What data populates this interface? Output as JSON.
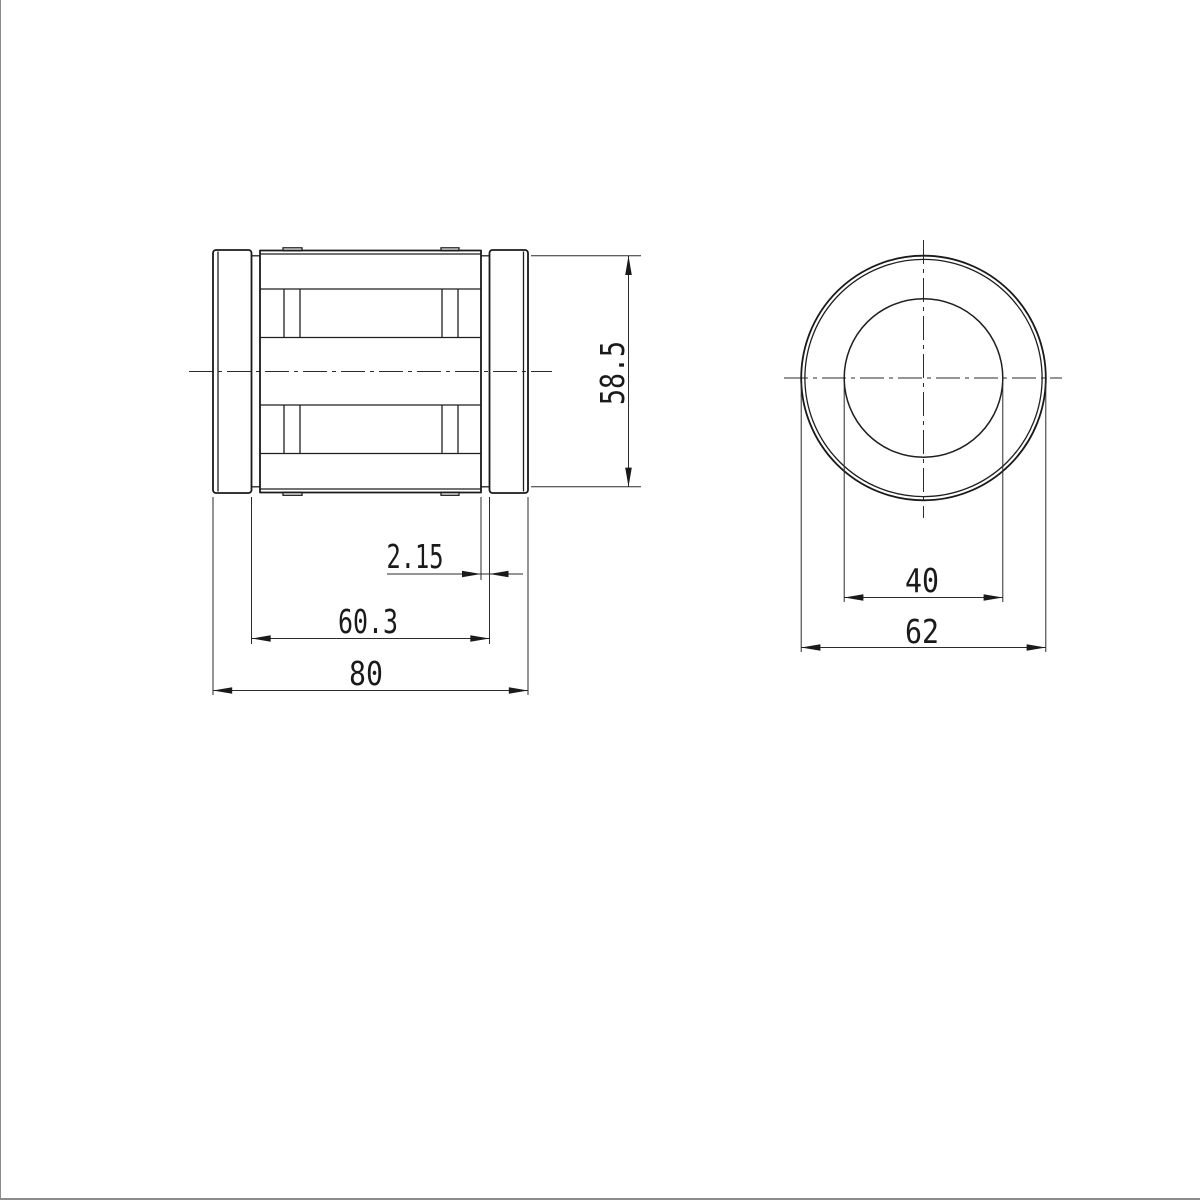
{
  "drawing": {
    "kind": "engineering-drawing-two-views",
    "background_color": "#ffffff",
    "line_color": "#1a1a1a",
    "dim_line_color": "#2b2b2b"
  },
  "side_view": {
    "dims": {
      "groove_diameter": {
        "label": "58.5",
        "value": 58.5,
        "orientation": "vertical"
      },
      "groove_width": {
        "label": "2.15",
        "value": 2.15,
        "orientation": "horizontal"
      },
      "groove_span": {
        "label": "60.3",
        "value": 60.3,
        "orientation": "horizontal"
      },
      "overall_length": {
        "label": "80",
        "value": 80,
        "orientation": "horizontal"
      }
    }
  },
  "front_view": {
    "dims": {
      "bore_diameter": {
        "label": "40",
        "value": 40,
        "orientation": "horizontal"
      },
      "outer_diameter": {
        "label": "62",
        "value": 62,
        "orientation": "horizontal"
      }
    }
  }
}
